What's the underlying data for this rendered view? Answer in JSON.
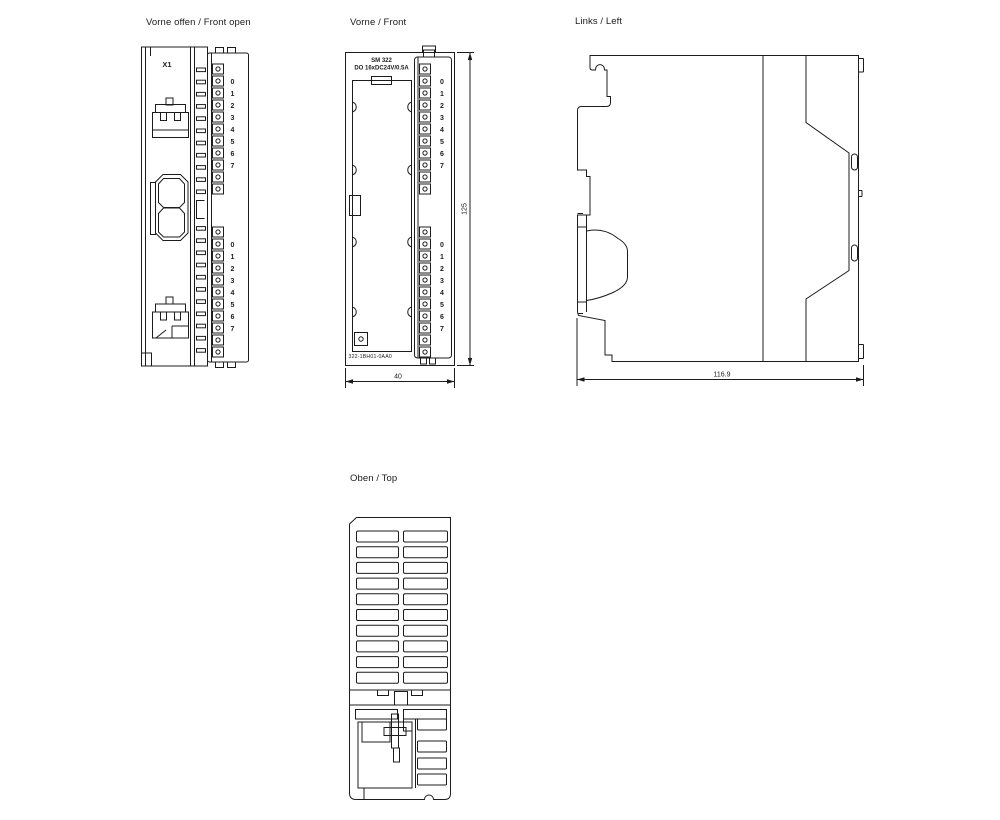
{
  "page": {
    "background": "#ffffff",
    "line_color": "#1c1c1c"
  },
  "channel_labels": [
    "0",
    "1",
    "2",
    "3",
    "4",
    "5",
    "6",
    "7"
  ],
  "views": {
    "front_open": {
      "title": "Vorne offen / Front open",
      "connector_label": "X1"
    },
    "front": {
      "title": "Vorne / Front",
      "module_line1": "SM 322",
      "module_line2": "DO 16xDC24V/0.5A",
      "order_number": "322-1BH01-0AA0",
      "dim_width": "40",
      "dim_height": "125"
    },
    "left": {
      "title": "Links / Left",
      "dim_depth": "116.9"
    },
    "top": {
      "title": "Oben / Top"
    }
  }
}
